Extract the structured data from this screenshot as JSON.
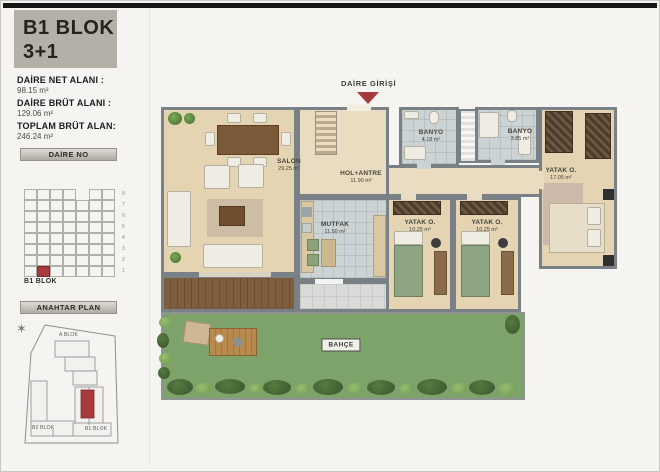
{
  "page": {
    "accent_red": "#a8393c"
  },
  "sidebar": {
    "title_line1": "B1 BLOK",
    "title_line2": "3+1",
    "stats": [
      {
        "label": "DAİRE NET ALANI :",
        "value": "98.15 m²"
      },
      {
        "label": "DAİRE BRÜT ALANI :",
        "value": "129.06 m²"
      },
      {
        "label": "TOPLAM BRÜT ALAN:",
        "value": "246.24 m²"
      }
    ],
    "daire_no": {
      "header": "DAİRE NO",
      "block_label": "B1 BLOK",
      "floors": [
        "8",
        "7",
        "6",
        "5",
        "4",
        "3",
        "2",
        "1"
      ],
      "grid": {
        "rows": 8,
        "cols": 7,
        "highlight": {
          "row": 7,
          "col": 1
        },
        "top_row_gap_col": 4
      }
    },
    "anahtar_plan": {
      "header": "ANAHTAR PLAN",
      "labels": {
        "a_blok": "A BLOK",
        "b2_blok": "B2 BLOK",
        "b1_blok": "B1 BLOK"
      }
    }
  },
  "plan": {
    "entrance_label": "DAİRE GİRİŞİ",
    "rooms": [
      {
        "id": "salon",
        "name": "SALON",
        "area": "29.25 m²"
      },
      {
        "id": "hol",
        "name": "HOL+ANTRE",
        "area": "11.90 m²"
      },
      {
        "id": "mutfak",
        "name": "MUTFAK",
        "area": "11.50 m²"
      },
      {
        "id": "banyo1",
        "name": "BANYO",
        "area": "4.18 m²"
      },
      {
        "id": "banyo2",
        "name": "BANYO",
        "area": "3.85 m²"
      },
      {
        "id": "yatak1",
        "name": "YATAK O.",
        "area": "10.25 m²"
      },
      {
        "id": "yatak2",
        "name": "YATAK O.",
        "area": "10.25 m²"
      },
      {
        "id": "yatak3",
        "name": "YATAK O.",
        "area": "17.05 m²"
      },
      {
        "id": "bahce",
        "name": "BAHÇE",
        "area": ""
      }
    ]
  }
}
